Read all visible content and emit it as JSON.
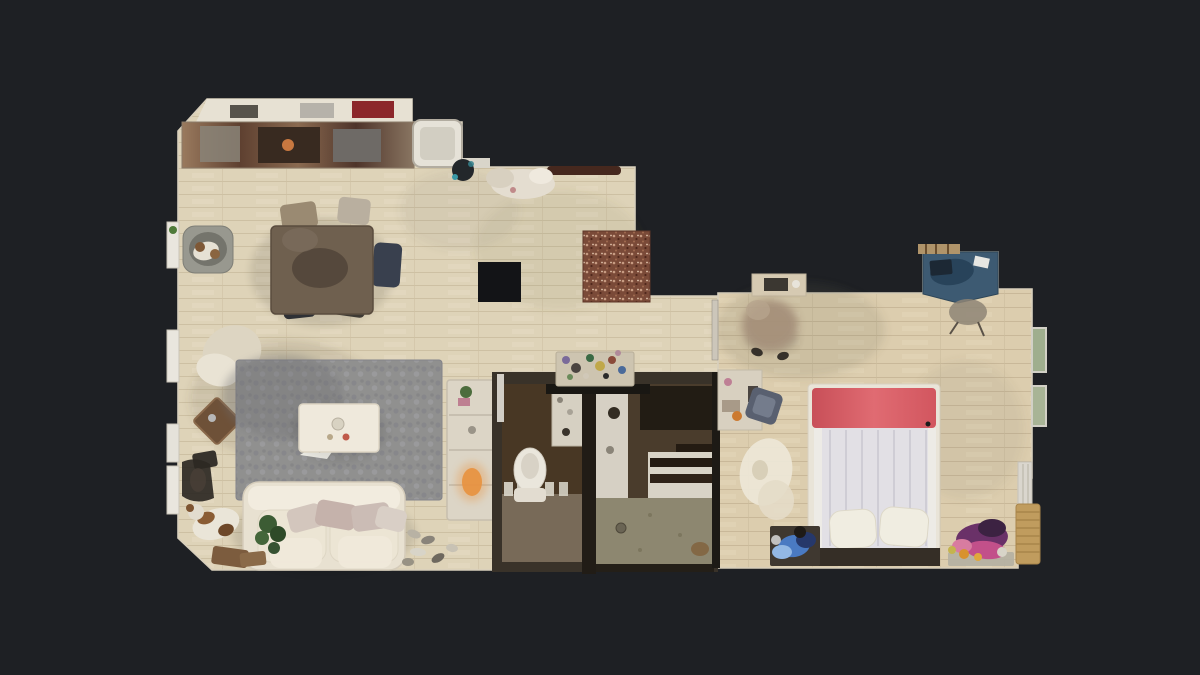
{
  "scene": {
    "type": "3d-dollhouse-floorplan-top-view",
    "description": "Top-down textured 3D scan floor plan of an apartment on a dark background",
    "text_visible": "none"
  },
  "colors": {
    "background": "#1e2024",
    "floor_wood": "#ded3b8",
    "floor_wood_line": "#c9bc9e",
    "floor_wood_bedroom": "#dccdae",
    "rug_gray": "#90908f",
    "doormat_brown": "#7a4a38",
    "bed_headboard_red": "#dd5f66",
    "bed_duvet": "#e2e0e5",
    "sofa_white": "#e8e1d1",
    "coffee_table_white": "#efe9dc",
    "dining_table_brown": "#6f604f",
    "desk_blue": "#3d5a72",
    "bathroom_floor_olive": "#8d8770",
    "wc_floor_brown": "#483724",
    "wall_dark": "#393229",
    "black_fixture": "#131417"
  },
  "rooms": [
    {
      "name": "kitchen",
      "objects": [
        "counter-strip",
        "white-cabinets",
        "stove",
        "sink",
        "white-tub-unit",
        "fan"
      ]
    },
    {
      "name": "dining-area",
      "objects": [
        "dining-table",
        "chairs",
        "dog-bed",
        "black-floor-square"
      ]
    },
    {
      "name": "living-room",
      "objects": [
        "gray-shag-rug",
        "white-coffee-table",
        "white-sofa",
        "pillows",
        "bookshelf",
        "dog",
        "plant",
        "shoes",
        "diamond-side-table",
        "white-blanket"
      ]
    },
    {
      "name": "entry-hall",
      "objects": [
        "speckled-doormat",
        "coat-rod",
        "laundry-pile",
        "mosaic-shelf"
      ]
    },
    {
      "name": "wc",
      "objects": [
        "toilet",
        "shelf",
        "radiator"
      ]
    },
    {
      "name": "bathroom",
      "objects": [
        "sink-counter",
        "mirror",
        "striped-mat",
        "olive-shower-floor",
        "drain"
      ]
    },
    {
      "name": "bedroom",
      "objects": [
        "double-bed-red-headboard",
        "duvet",
        "pillows",
        "bench",
        "blue-desk",
        "desk-chair",
        "person-motion-blur",
        "sheepskin-rug",
        "blue-clothes-pile",
        "purple-clothes-pile",
        "dresser",
        "wicker-basket",
        "curtain",
        "green-windows"
      ]
    }
  ]
}
